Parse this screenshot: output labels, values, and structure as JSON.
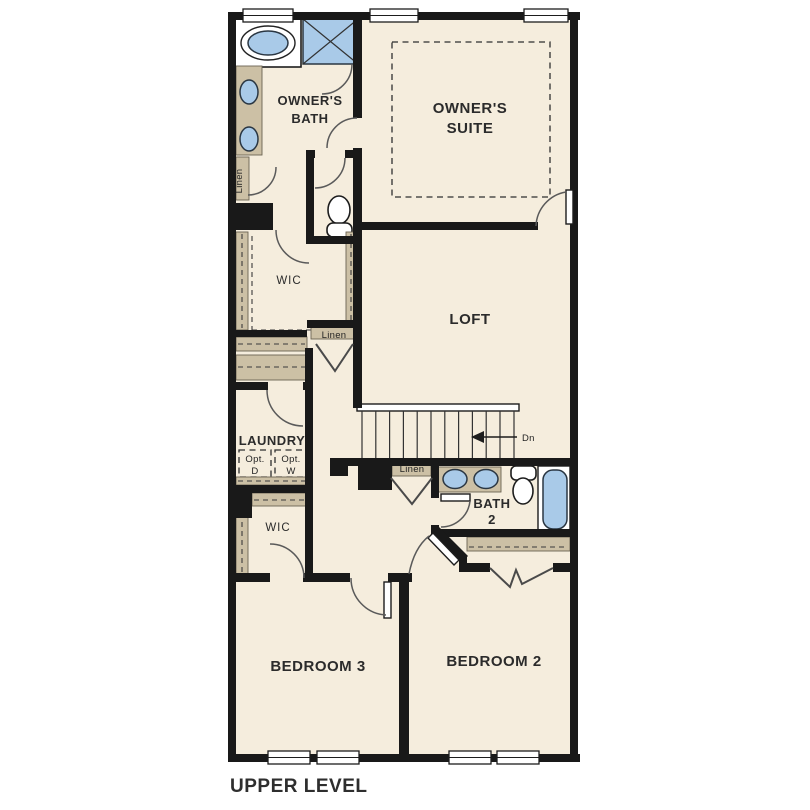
{
  "plan": {
    "level_title": "UPPER LEVEL",
    "rooms": {
      "owners_suite": {
        "line1": "OWNER'S",
        "line2": "SUITE"
      },
      "owners_bath": {
        "line1": "OWNER'S",
        "line2": "BATH"
      },
      "wic_owners": {
        "label": "WIC"
      },
      "loft": {
        "label": "LOFT"
      },
      "laundry": {
        "label": "LAUNDRY"
      },
      "wic_bedroom3": {
        "label": "WIC"
      },
      "bath2": {
        "line1": "BATH",
        "line2": "2"
      },
      "bedroom3": {
        "label": "BEDROOM 3"
      },
      "bedroom2": {
        "label": "BEDROOM 2"
      }
    },
    "closets": {
      "linen_owners_bath": {
        "label": "Linen"
      },
      "linen_hall": {
        "label": "Linen"
      },
      "linen_under_stairs": {
        "label": "Linen"
      }
    },
    "laundry_options": {
      "dryer": {
        "line1": "Opt.",
        "line2": "D"
      },
      "washer": {
        "line1": "Opt.",
        "line2": "W"
      }
    },
    "stairs": {
      "direction_label": "Dn"
    }
  },
  "colors": {
    "floor": "#f5eddd",
    "wall": "#191919",
    "casework": "#ccc0a5",
    "fixture": "#a9cae8",
    "arcline": "#5a5a5a",
    "text": "#2b2b2b",
    "background": "#ffffff"
  }
}
